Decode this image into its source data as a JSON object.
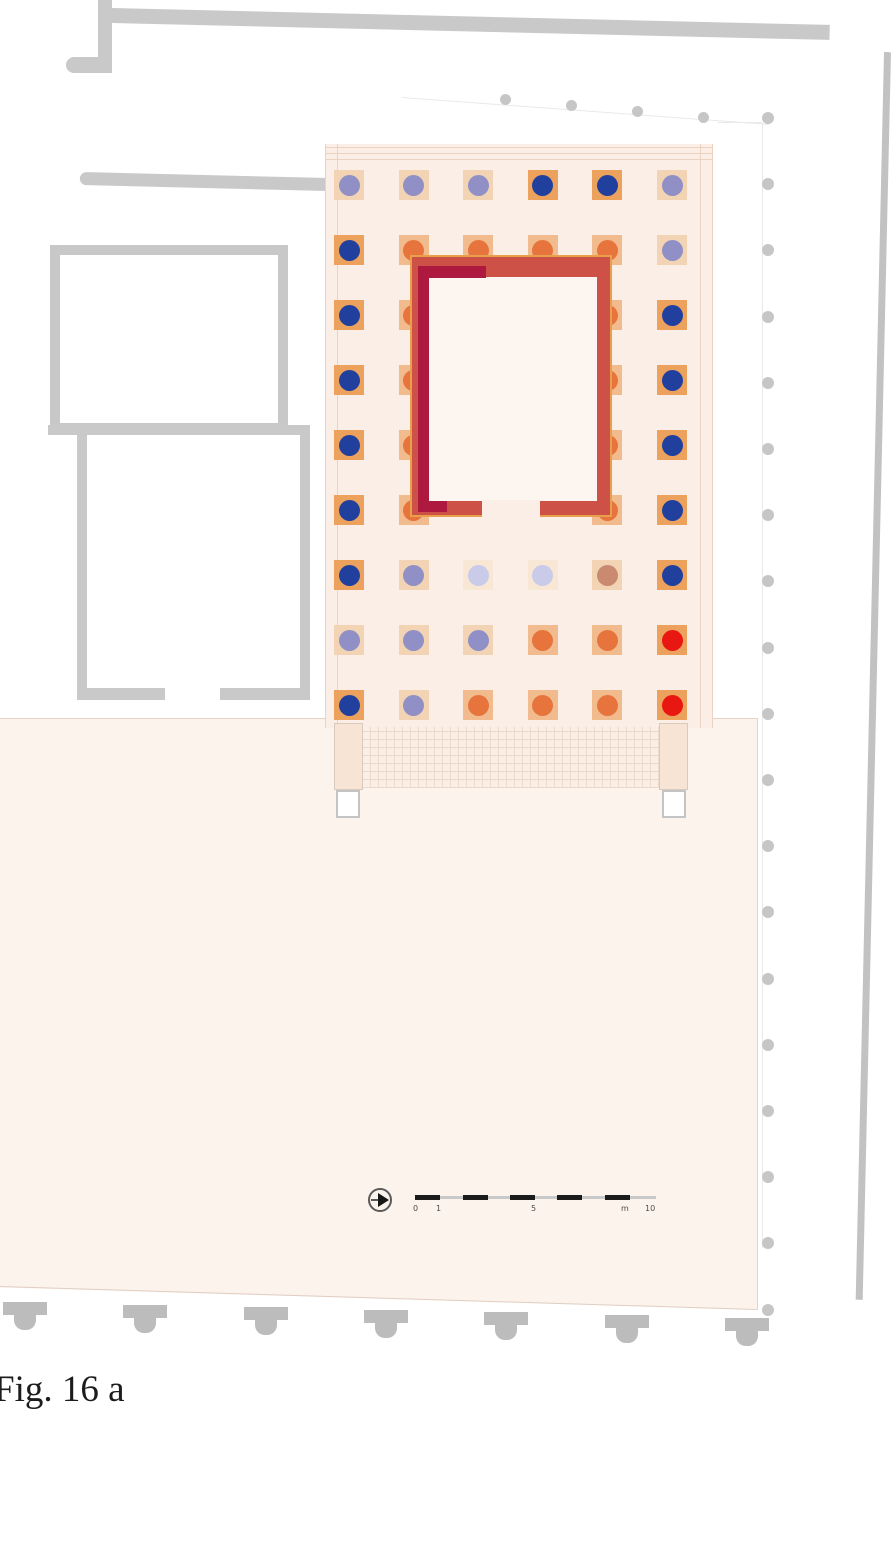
{
  "figure": {
    "caption": "Fig. 16 a"
  },
  "scale_bar": {
    "labels": [
      "0",
      "1",
      "5",
      "m",
      "10"
    ],
    "black_segments": 5,
    "unit": "m"
  },
  "icons": {
    "north_arrow": "north-arrow-icon"
  },
  "colors": {
    "navy": "#21409e",
    "lavender": "#908fc6",
    "pale_lavender": "#cacbe8",
    "orange": "#e6743c",
    "dusty": "#c98a6f",
    "red": "#e81712",
    "wall_red": "#cd5147",
    "wall_crimson": "#ae1a3f",
    "wall_outline": "#e9a04c",
    "context_gray": "#c9c9c9",
    "platform_pink": "#fbeee7",
    "plaza_pink": "#fcf3ed"
  },
  "plinth_map": {
    "navy": "#eca25d",
    "red": "#eca25d",
    "orange": "#f2bb8e",
    "lavender": "#f2d4b5",
    "pale_lavender": "#f8e7d5",
    "dusty": "#f2d4b5"
  },
  "temple": {
    "columns_per_row": 6,
    "rows": [
      {
        "cells": [
          "lavender",
          "lavender",
          "lavender",
          "navy",
          "navy",
          "lavender"
        ]
      },
      {
        "cells": [
          "navy",
          "orange",
          "orange",
          "orange",
          "orange",
          "lavender"
        ]
      },
      {
        "cells": [
          "navy",
          "orange",
          null,
          null,
          "orange",
          "navy"
        ]
      },
      {
        "cells": [
          "navy",
          "orange",
          null,
          null,
          "orange",
          "navy"
        ]
      },
      {
        "cells": [
          "navy",
          "orange",
          null,
          null,
          "orange",
          "navy"
        ]
      },
      {
        "cells": [
          "navy",
          "orange",
          null,
          null,
          "orange",
          "navy"
        ]
      },
      {
        "cells": [
          "navy",
          "lavender",
          "pale_lavender",
          "pale_lavender",
          "dusty",
          "navy"
        ]
      },
      {
        "cells": [
          "lavender",
          "lavender",
          "lavender",
          "orange",
          "orange",
          "red"
        ]
      },
      {
        "cells": [
          "navy",
          "lavender",
          "orange",
          "orange",
          "orange",
          "red"
        ]
      }
    ]
  },
  "counts": {
    "right_colonnade_dots": 19,
    "top_colonnade_dots": 4,
    "bottom_column_bases": 7
  }
}
